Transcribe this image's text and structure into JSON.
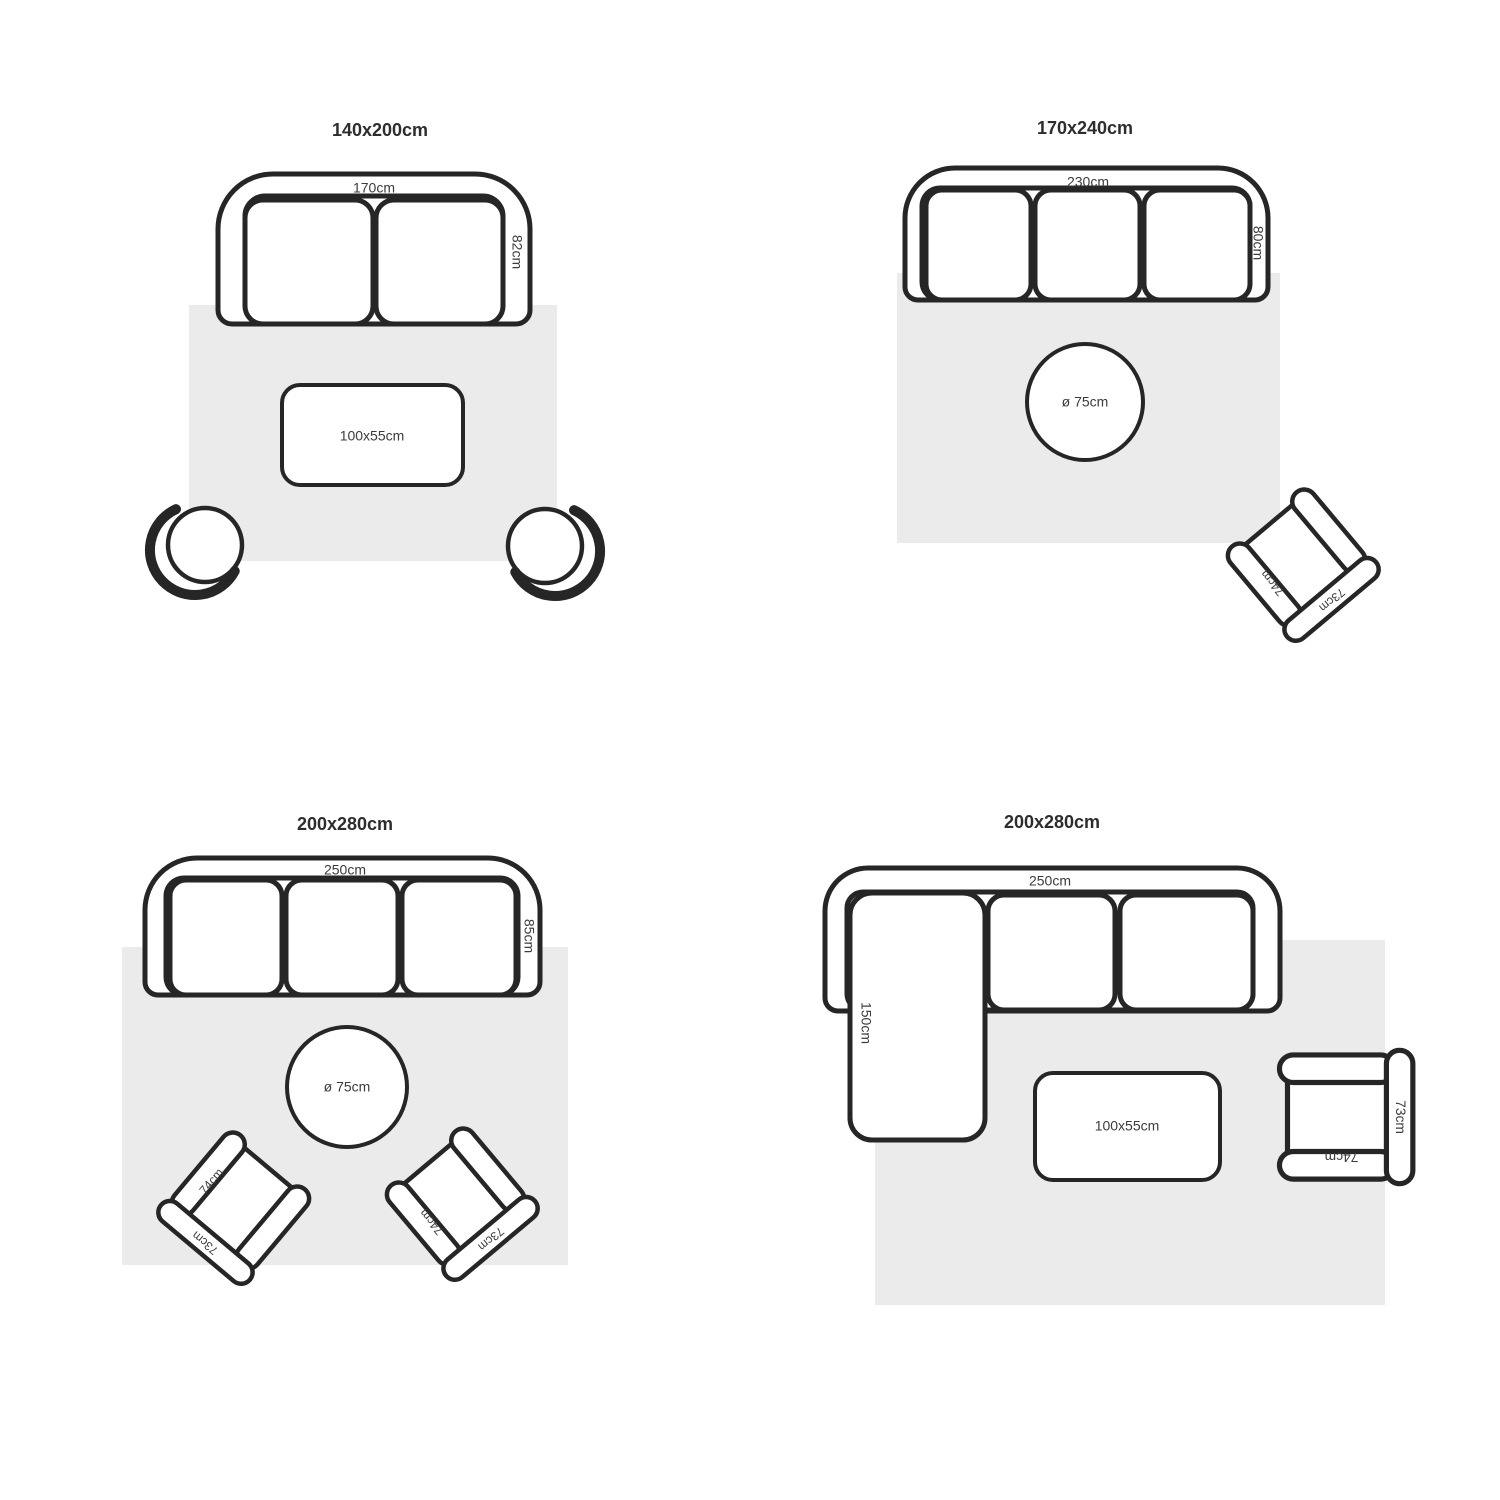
{
  "colors": {
    "outline": "#262626",
    "rug_fill": "#ebebeb",
    "label_text": "#3c3c3c",
    "title_text": "#2d2d2d",
    "background": "#ffffff"
  },
  "armchair_labels": {
    "width": "74cm",
    "depth": "73cm"
  },
  "panels": [
    {
      "title": "140x200cm",
      "sofa_width_label": "170cm",
      "sofa_depth_label": "82cm",
      "coffee_table_label": "100x55cm"
    },
    {
      "title": "170x240cm",
      "sofa_width_label": "230cm",
      "sofa_depth_label": "80cm",
      "round_table_label": "ø 75cm"
    },
    {
      "title": "200x280cm",
      "sofa_width_label": "250cm",
      "sofa_depth_label": "85cm",
      "round_table_label": "ø 75cm"
    },
    {
      "title": "200x280cm",
      "sofa_width_label": "250cm",
      "chaise_length_label": "150cm",
      "coffee_table_label": "100x55cm"
    }
  ]
}
